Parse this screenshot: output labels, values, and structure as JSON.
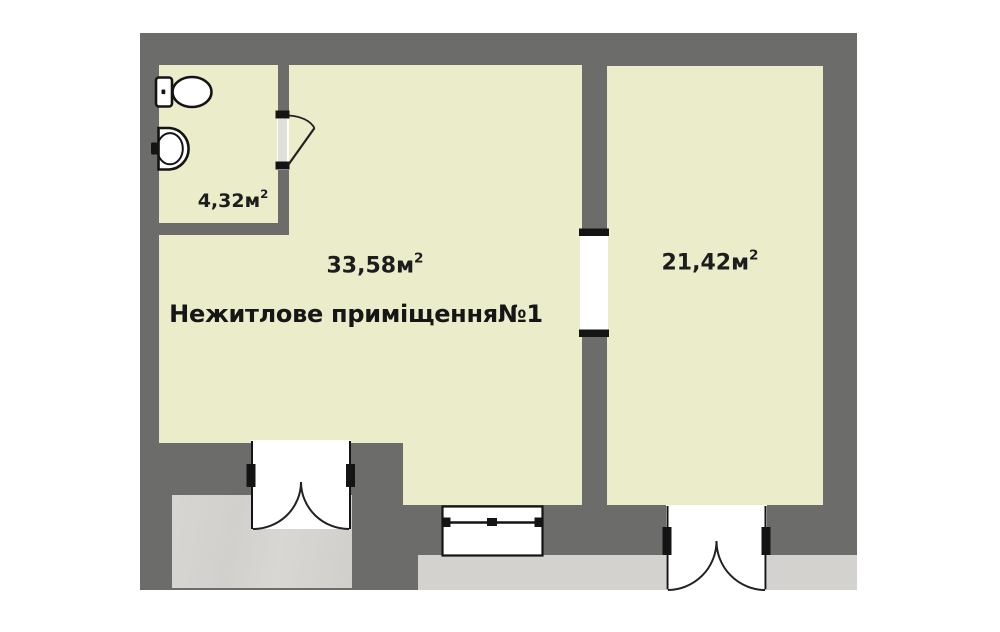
{
  "floor_plan": {
    "unit_title": "Нежитлове приміщення№1",
    "rooms": [
      {
        "id": "bathroom",
        "area_value": "4,32",
        "area_unit": "м",
        "area_sup": "2"
      },
      {
        "id": "main-room",
        "area_value": "33,58",
        "area_unit": "м",
        "area_sup": "2",
        "label": "Нежитлове приміщення№1"
      },
      {
        "id": "right-room",
        "area_value": "21,42",
        "area_unit": "м",
        "area_sup": "2"
      }
    ],
    "colors": {
      "page": "#ffffff",
      "wall_gray": "#6c6c6a",
      "room_fill": "#ebecca",
      "outside_gray": "#d3d2cf",
      "line_black": "#141414"
    },
    "icons": [
      "toilet-icon",
      "sink-icon",
      "door-swing-icon",
      "double-door-icon",
      "window-icon",
      "wall-opening"
    ]
  }
}
